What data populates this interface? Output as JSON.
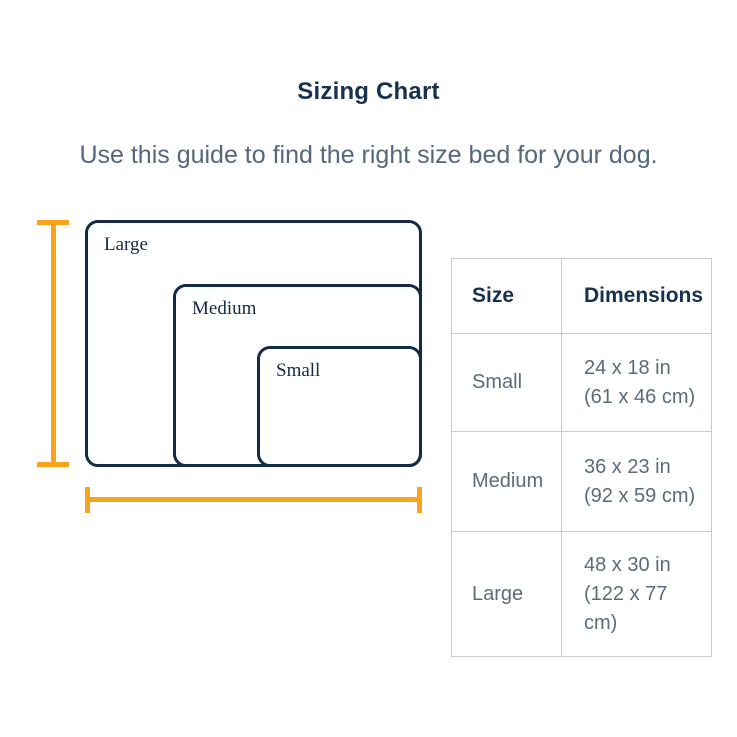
{
  "page": {
    "title": "Sizing Chart",
    "subtitle": "Use this guide to find the right size bed for your dog."
  },
  "diagram": {
    "beds": [
      {
        "label": "Large"
      },
      {
        "label": "Medium"
      },
      {
        "label": "Small"
      }
    ]
  },
  "table": {
    "headers": {
      "size": "Size",
      "dimensions": "Dimensions"
    },
    "rows": [
      {
        "size": "Small",
        "dimensions_lines": [
          "24 x 18 in",
          "(61 x 46 cm)"
        ]
      },
      {
        "size": "Medium",
        "dimensions_lines": [
          "36 x 23 in",
          "(92 x 59 cm)"
        ]
      },
      {
        "size": "Large",
        "dimensions_lines": [
          "48 x 30 in",
          "(122 x 77",
          "cm)"
        ]
      }
    ]
  },
  "colors": {
    "heading_navy": "#16304D",
    "outline_navy": "#132B45",
    "body_slate": "#5B6B79",
    "subtitle_slate": "#54677C",
    "accent_orange": "#F9A21B",
    "table_border": "#CBCBCB"
  }
}
